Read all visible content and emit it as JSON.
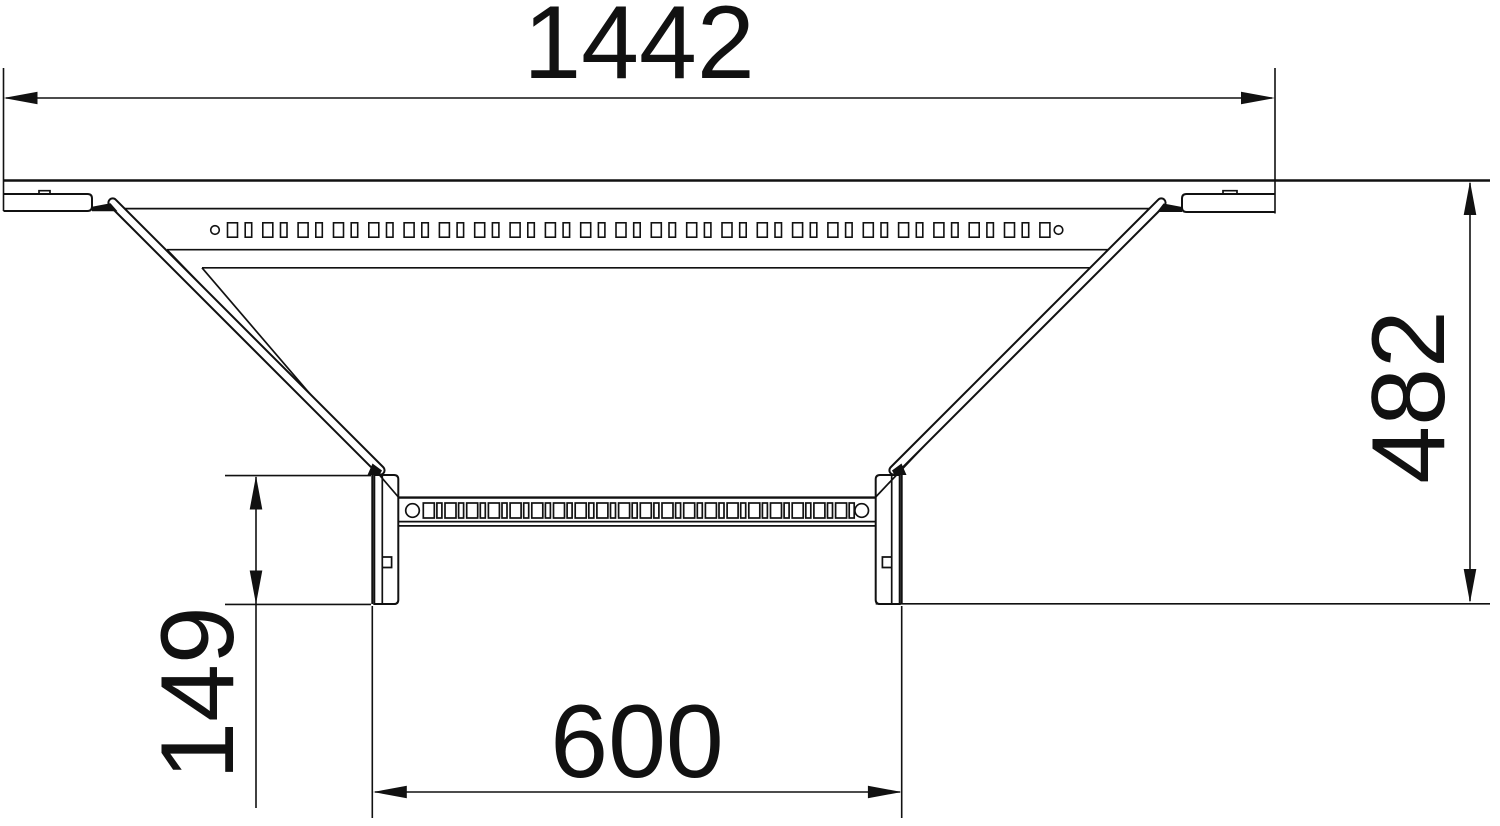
{
  "drawing": {
    "colors": {
      "line": "#111111",
      "background": "#ffffff"
    },
    "dimensions": {
      "top_width": "1442",
      "right_height": "482",
      "left_offset": "149",
      "branch_width": "600"
    }
  }
}
